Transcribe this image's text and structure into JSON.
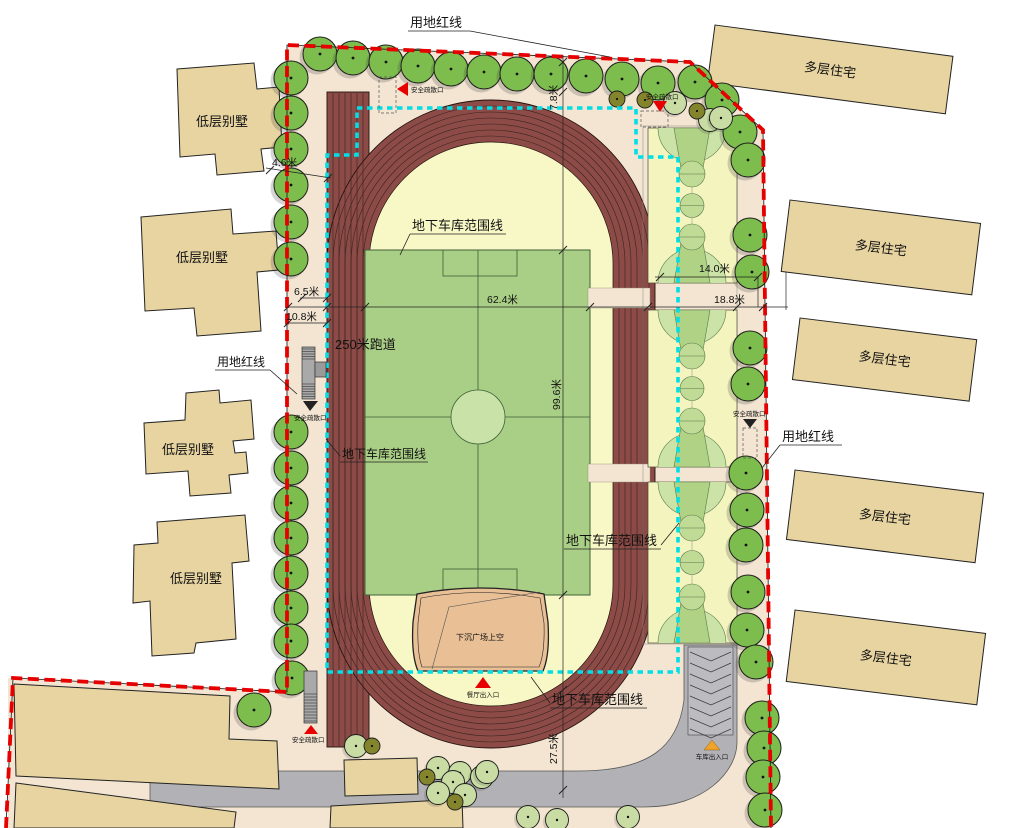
{
  "labels": {
    "boundary": "用地红线",
    "garage_line": "地下车库范围线",
    "track": "250米跑道",
    "evac": "安全疏散口",
    "restaurant_entrance": "餐厅出入口",
    "garage_entrance": "车库出入口",
    "plaza": "下沉广场上空",
    "villa": "低层别墅",
    "apartment": "多层住宅"
  },
  "dimensions": {
    "d78": "7.8米",
    "d46": "4.6米",
    "d65": "6.5米",
    "d108": "10.8米",
    "d624": "62.4米",
    "d188": "18.8米",
    "d140": "14.0米",
    "d996": "99.6米",
    "d275": "27.5米"
  },
  "colors": {
    "boundary_red": "#e60000",
    "garage_cyan": "#00dfe6",
    "track_maroon": "#8c4b46",
    "infield_yellow": "#f8f8c6",
    "field_green": "#a9ce85",
    "court_yellow": "#f4f4bf",
    "key_green": "#afd284",
    "tree_green": "#7dbd4d",
    "ground_tan": "#f3e5d2",
    "building_tan": "#e7d4a1",
    "road_gray": "#b2b2b6",
    "plaza_orange": "#e9bf96",
    "entrance_orange": "#f0a32a"
  }
}
